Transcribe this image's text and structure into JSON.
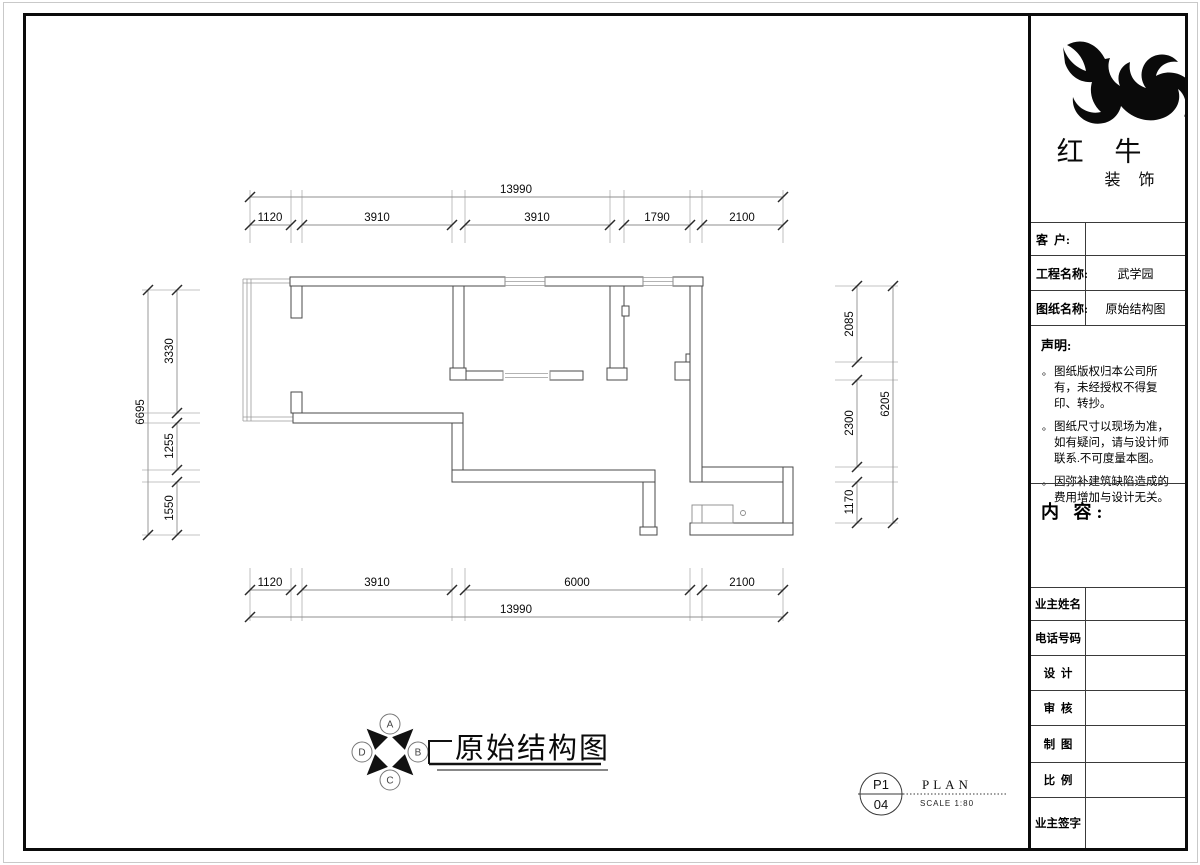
{
  "title_block": {
    "brand": {
      "line1": "红 牛",
      "line2": "装 饰"
    },
    "fields": [
      {
        "label": "客  户:",
        "value": ""
      },
      {
        "label": "工程名称:",
        "value": "武学园"
      },
      {
        "label": "图纸名称:",
        "value": "原始结构图"
      }
    ],
    "statement": {
      "heading": "声明:",
      "items": [
        "图纸版权归本公司所有，未经授权不得复印、转抄。",
        "图纸尺寸以现场为准，如有疑问，请与设计师联系.不可度量本图。",
        "因弥补建筑缺陷造成的费用增加与设计无关。"
      ]
    },
    "content_heading": "内 容:",
    "signature_rows": [
      {
        "label": "业主姓名",
        "value": ""
      },
      {
        "label": "电话号码",
        "value": ""
      },
      {
        "label": "设  计",
        "value": ""
      },
      {
        "label": "审  核",
        "value": ""
      },
      {
        "label": "制  图",
        "value": ""
      },
      {
        "label": "比  例",
        "value": ""
      },
      {
        "label": "业主签字",
        "value": ""
      }
    ]
  },
  "plan": {
    "dimensions": {
      "top": {
        "overall": "13990",
        "segments": [
          "1120",
          "3910",
          "3910",
          "1790",
          "2100"
        ]
      },
      "bottom": {
        "overall": "13990",
        "segments": [
          "1120",
          "3910",
          "6000",
          "2100"
        ]
      },
      "left": {
        "overall": "6695",
        "segments": [
          "3330",
          "1255",
          "1550"
        ]
      },
      "right": {
        "overall": "6205",
        "segments": [
          "2085",
          "2300",
          "1170"
        ]
      }
    }
  },
  "footer": {
    "drawing_title": "原始结构图",
    "elevation_marker": {
      "letters": [
        "A",
        "B",
        "C",
        "D"
      ]
    },
    "sheet": {
      "number_top": "P1",
      "number_bottom": "04",
      "type_label": "PLAN",
      "scale_label": "SCALE 1:80"
    }
  },
  "colors": {
    "wall_line": "#4a4a4a",
    "dim_line": "#9a9a9a",
    "ink": "#000000"
  }
}
